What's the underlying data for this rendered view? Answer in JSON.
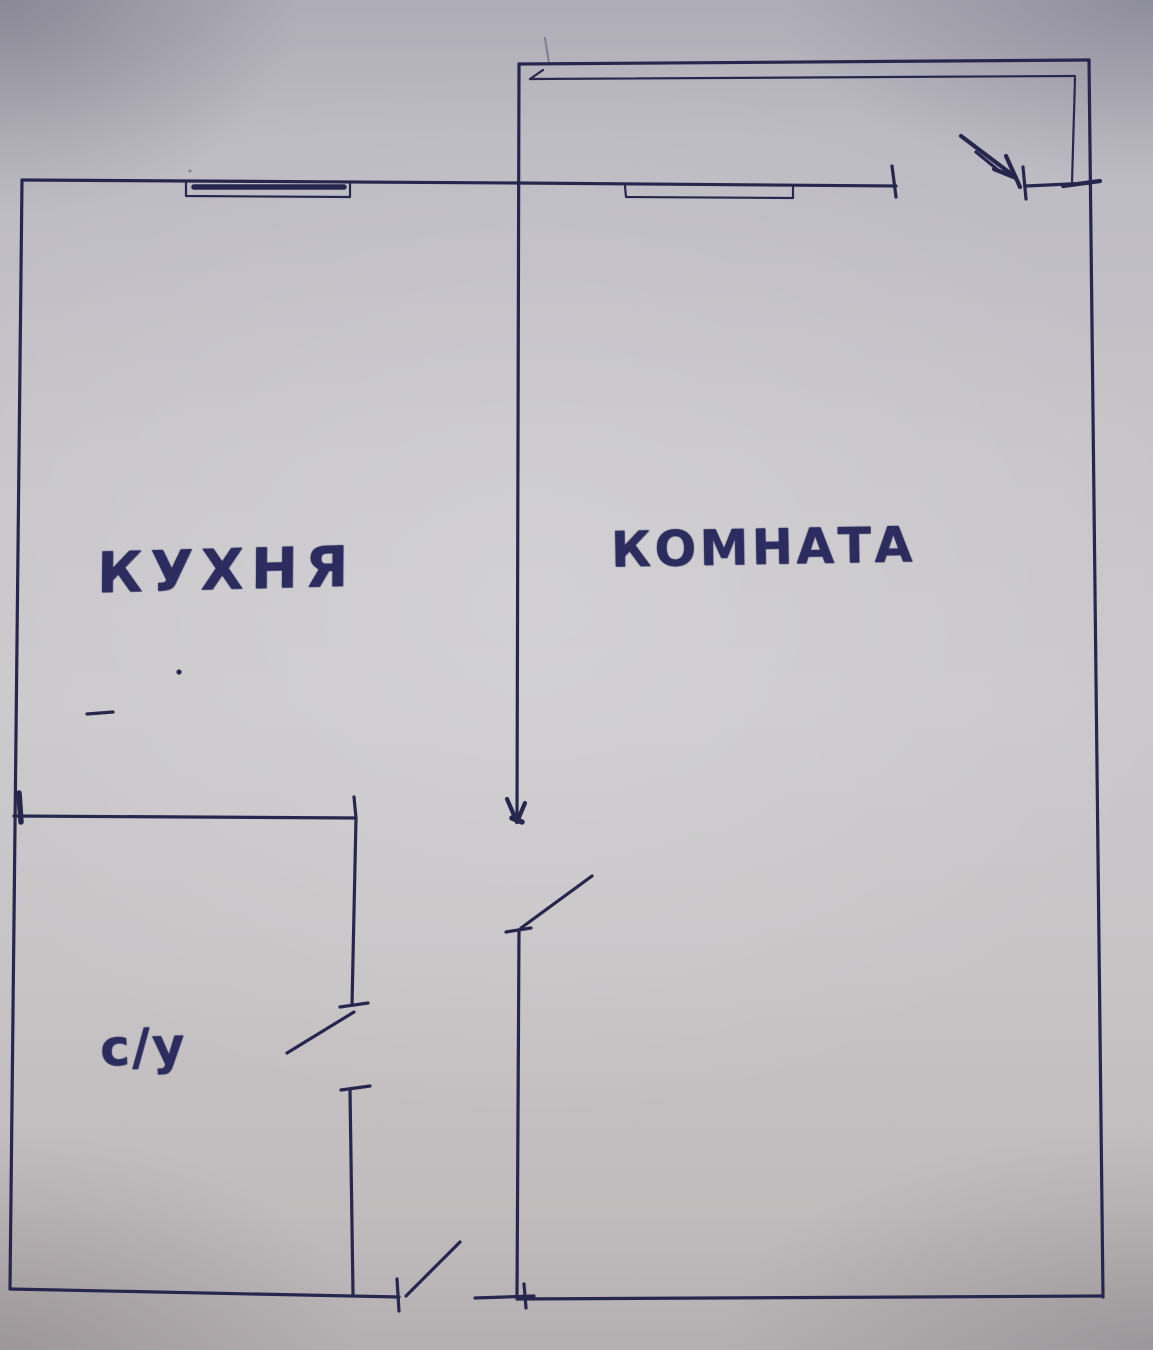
{
  "document": {
    "title": "Hand-drawn apartment floor plan",
    "language": "ru"
  },
  "rooms": {
    "kitchen": {
      "label": "КУХНЯ"
    },
    "living_room": {
      "label": "КОМНАТА"
    },
    "bathroom": {
      "label": "с/у"
    }
  },
  "symbols": {
    "windows": 3,
    "door_swings": 3,
    "entry_arrow": 1
  },
  "colors": {
    "ink": "#27274e",
    "label_ink": "#2c2c5e",
    "paper": "#c7c5c9"
  }
}
